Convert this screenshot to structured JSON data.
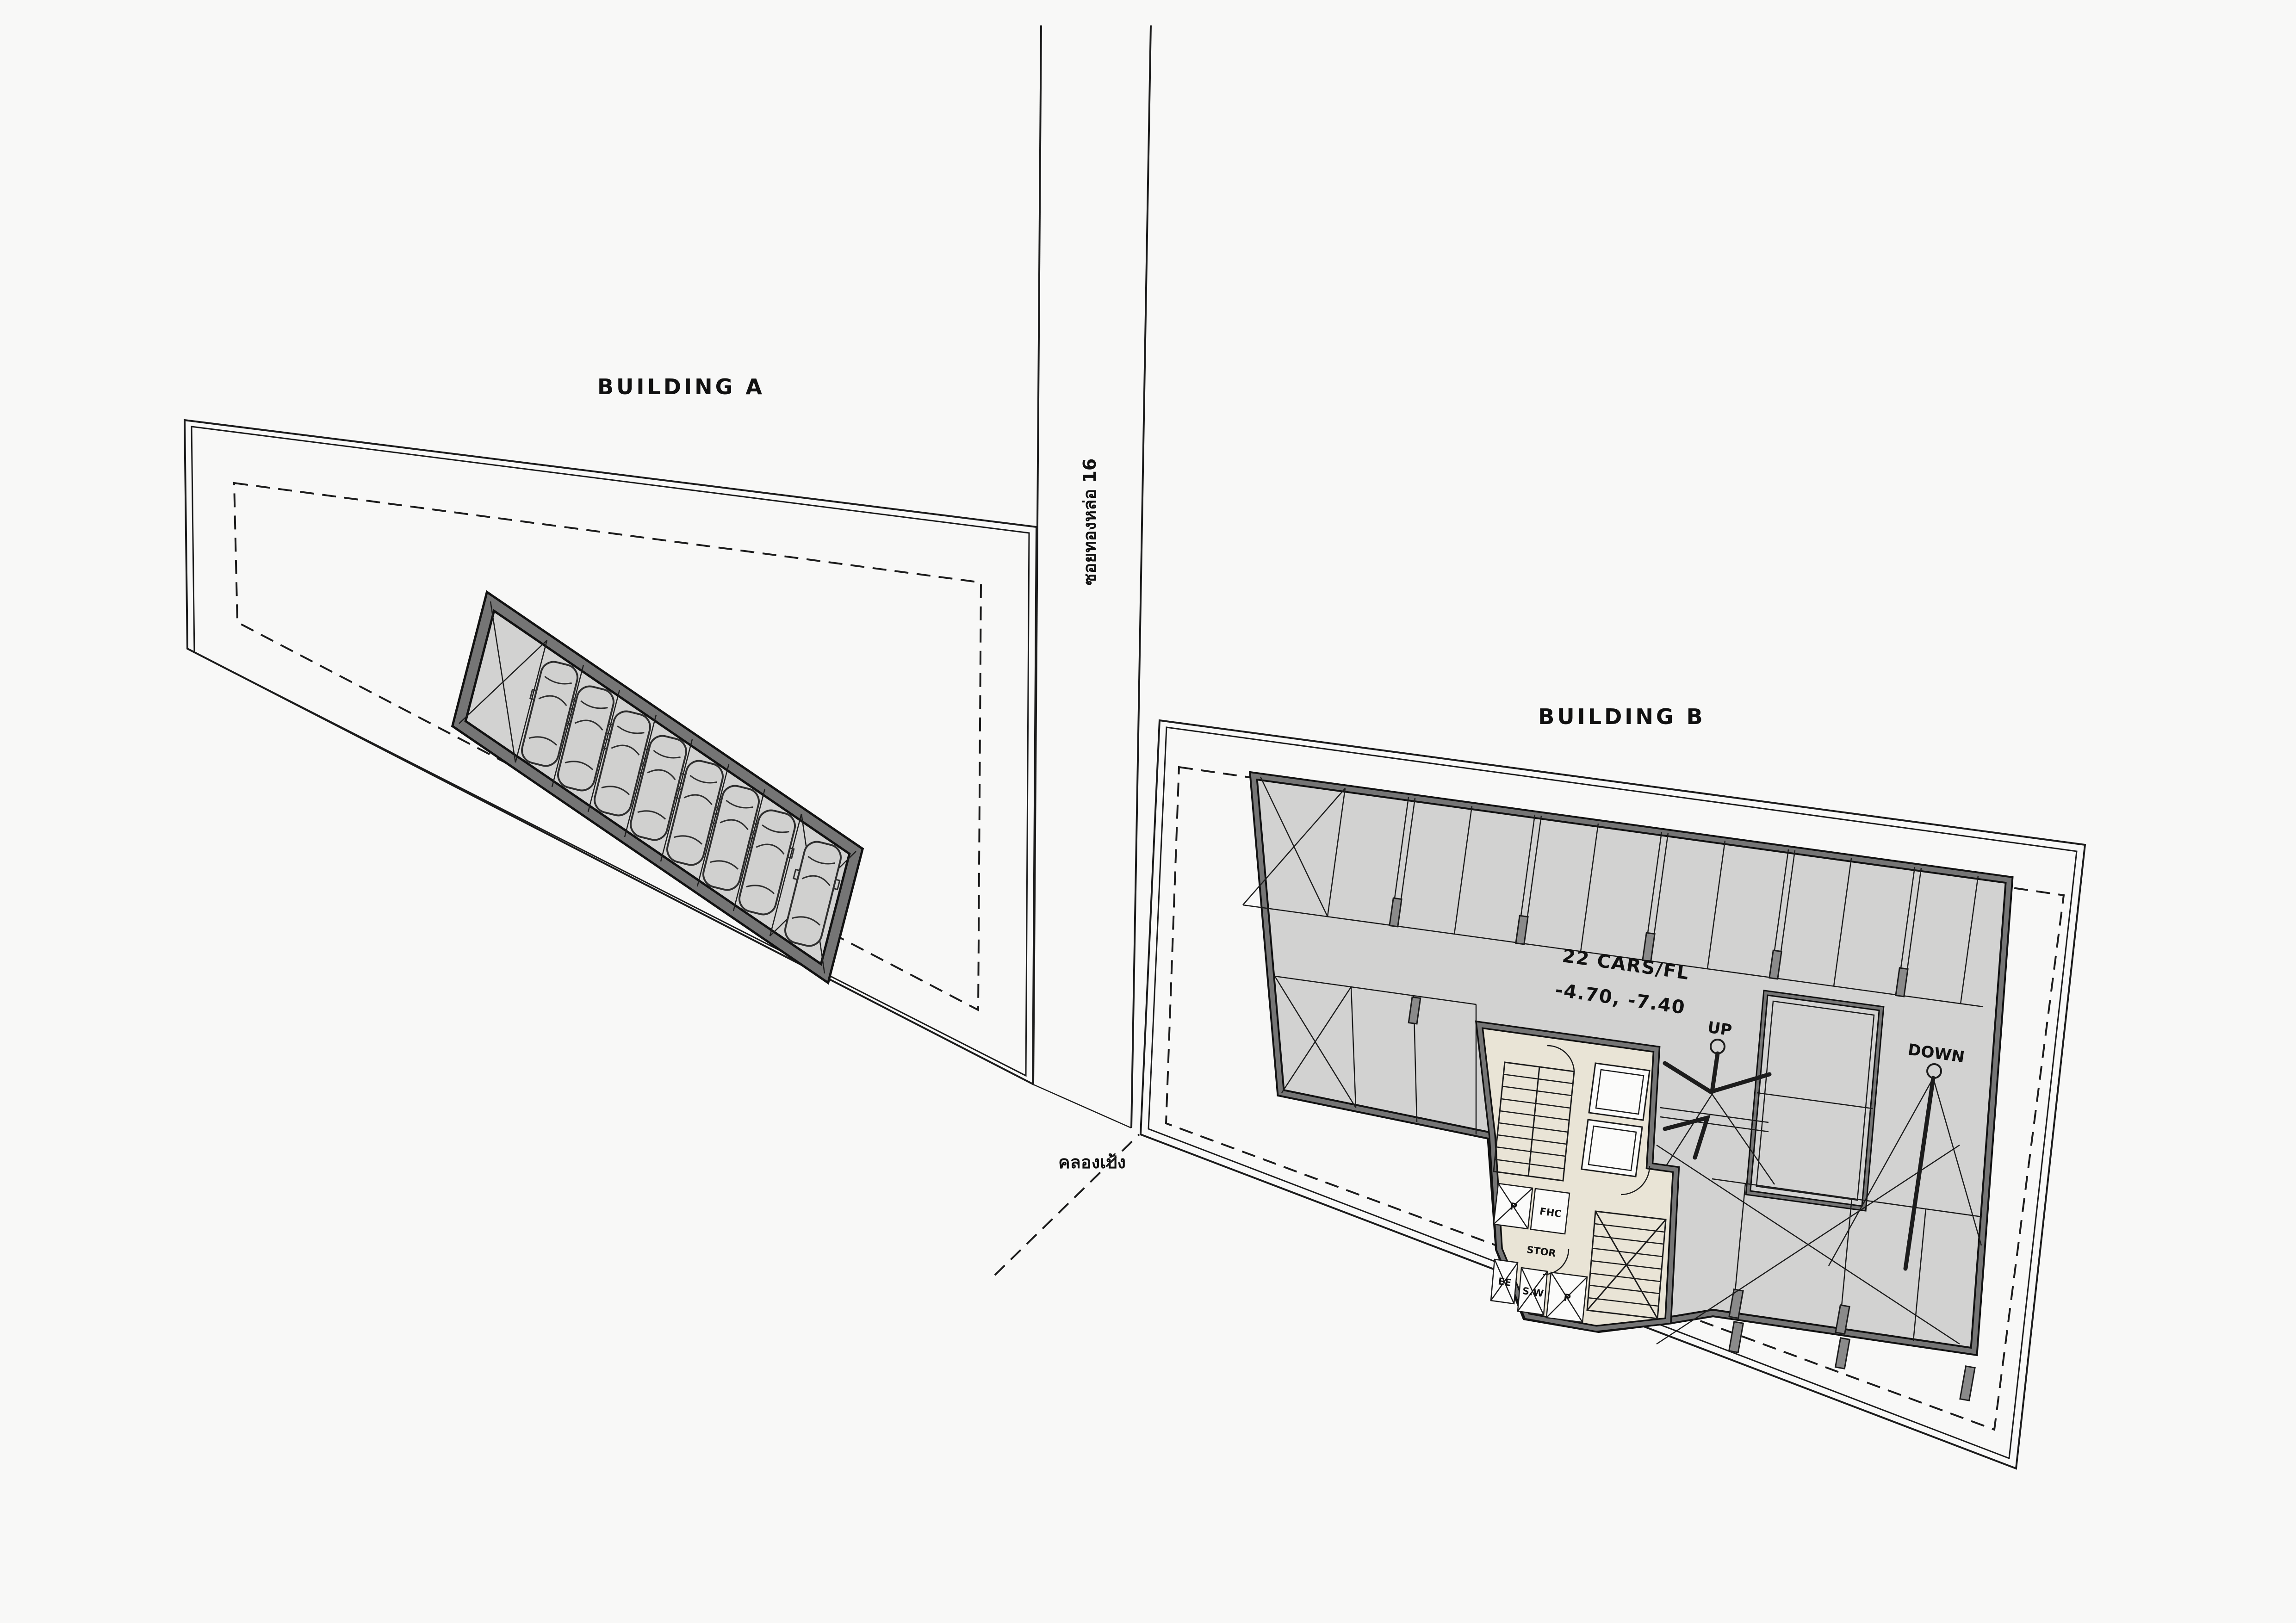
{
  "page": {
    "background": "#f8f8f7",
    "line_color": "#1c1c1c",
    "plate_fill": "#d2d2d1",
    "wall_gray": "#757575",
    "core_fill": "#e9e4d6",
    "shaft_fill": "#fbfbfa",
    "column_fill": "#8a8a8a"
  },
  "roads": {
    "soi_label": "ซอยทองหล่อ 16",
    "canal_label": "คลองเป้ง"
  },
  "buildings": {
    "a": {
      "label": "BUILDING A",
      "car_count": 8,
      "stall_rows": 1
    },
    "b": {
      "label": "BUILDING B",
      "capacity_note": "22 CARS/FL",
      "levels_note": "-4.70, -7.40",
      "ramp_up_label": "UP",
      "ramp_down_label": "DOWN"
    }
  },
  "core_rooms": {
    "shaft_p": "P",
    "fire_hose": "FHC",
    "storage": "STOR",
    "electrical": "EE",
    "shaft_sw": "S.W",
    "shaft_p2": "P"
  }
}
